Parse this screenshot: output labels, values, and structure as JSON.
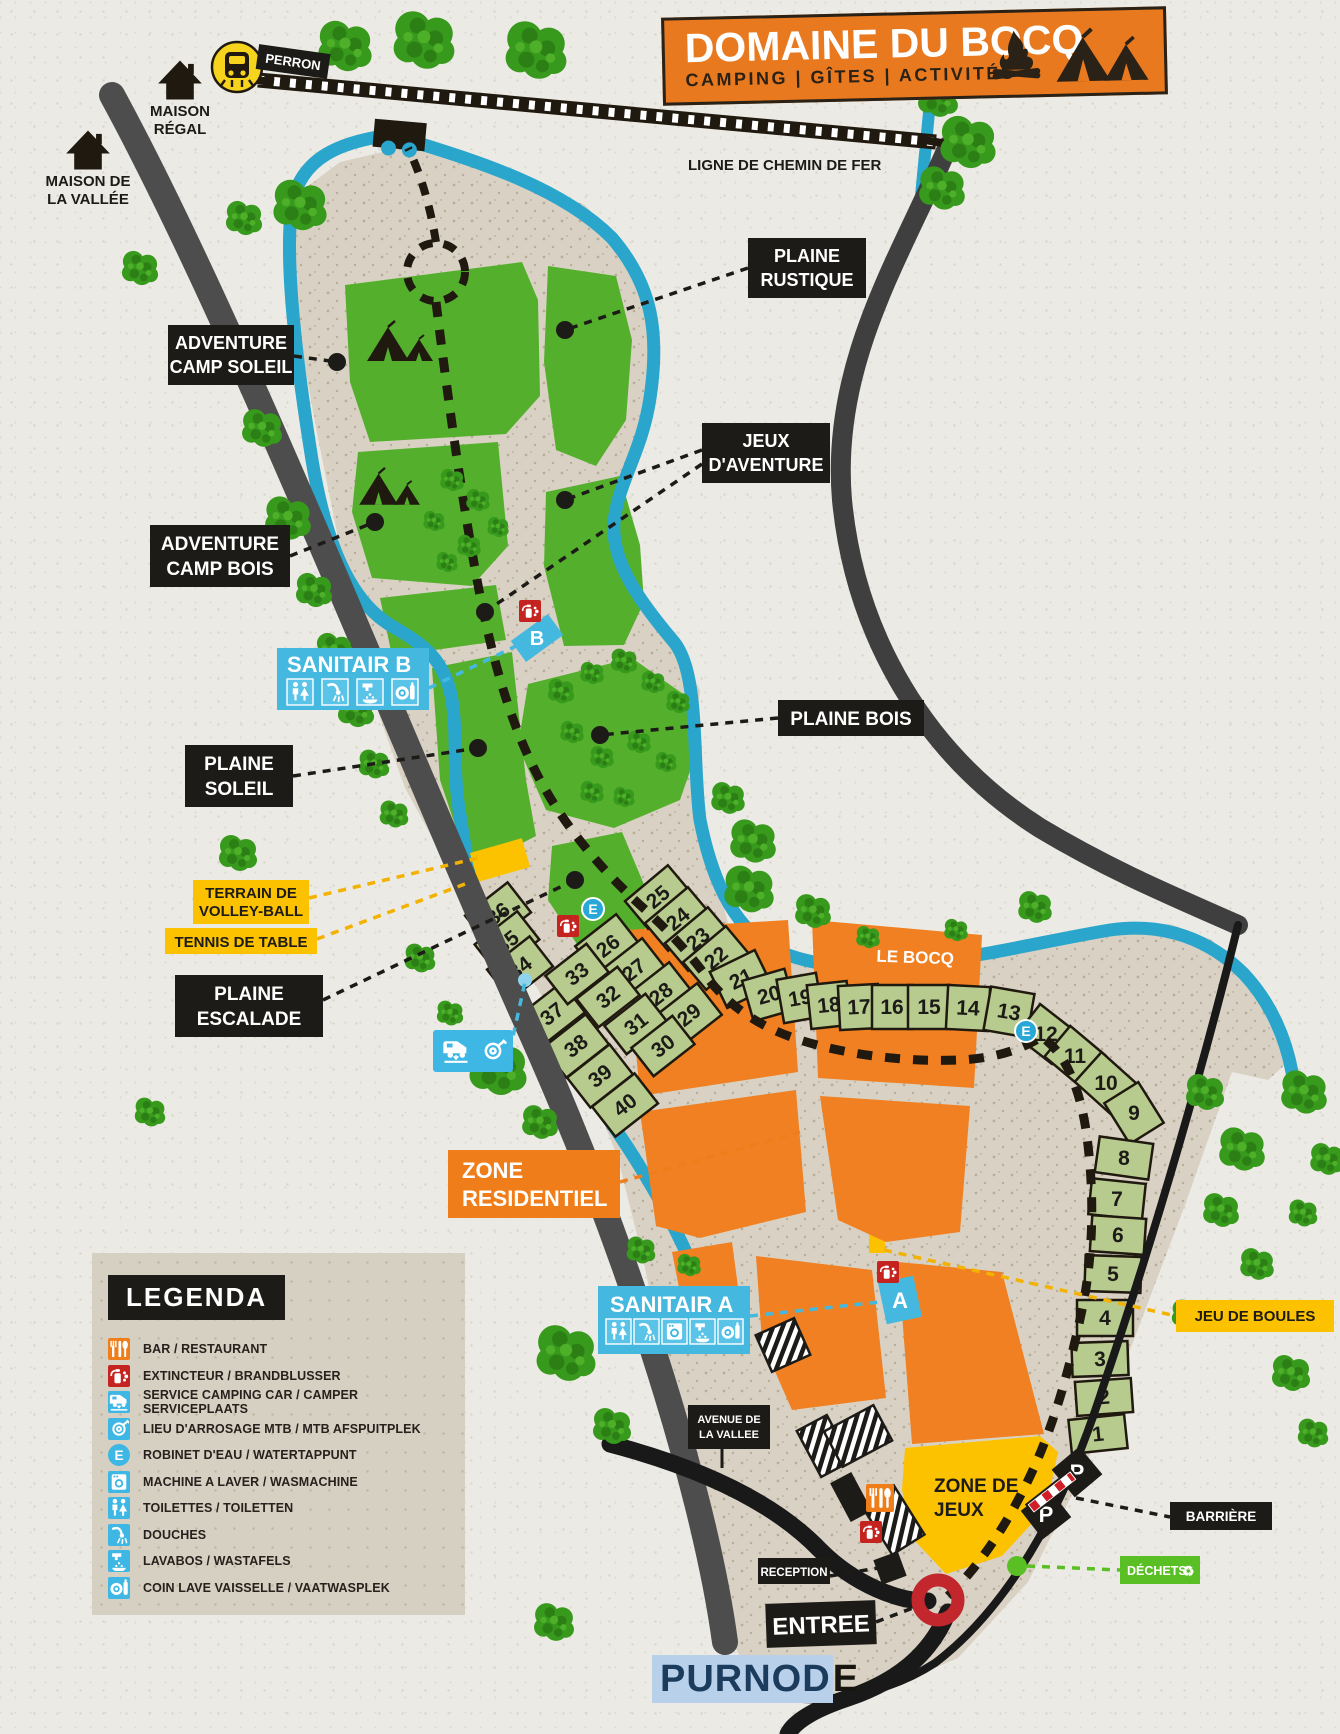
{
  "header": {
    "title": "DOMAINE DU BOCQ",
    "subtitle": "CAMPING | GÎTES | ACTIVITÉS"
  },
  "landmarks": {
    "maison_regal_line1": "MAISON",
    "maison_regal_line2": "RÉGAL",
    "maison_vallee_line1": "MAISON DE",
    "maison_vallee_line2": "LA VALLÉE",
    "perron": "PERRON",
    "railway": "LIGNE DE CHEMIN DE FER",
    "village_part1": "PURNOD",
    "village_part2": "E"
  },
  "river": {
    "name": "LE BOCQ"
  },
  "areas": {
    "adventure_camp_soleil": [
      "ADVENTURE",
      "CAMP SOLEIL"
    ],
    "plaine_rustique": [
      "PLAINE",
      "RUSTIQUE"
    ],
    "jeux_aventure": [
      "JEUX",
      "D'AVENTURE"
    ],
    "adventure_camp_bois": [
      "ADVENTURE",
      "CAMP BOIS"
    ],
    "plaine_soleil": [
      "PLAINE",
      "SOLEIL"
    ],
    "plaine_bois": "PLAINE BOIS",
    "terrain_volley": [
      "TERRAIN DE",
      "VOLLEY-BALL"
    ],
    "tennis_table": "TENNIS DE TABLE",
    "plaine_escalade": [
      "PLAINE",
      "ESCALADE"
    ],
    "zone_residentiel": [
      "ZONE",
      "RESIDENTIEL"
    ],
    "zone_jeux": [
      "ZONE DE",
      "JEUX"
    ],
    "jeu_boules": "JEU DE BOULES"
  },
  "facilities": {
    "sanitair_a": "SANITAIR A",
    "sanitair_b": "SANITAIR B",
    "sanitair_a_letter": "A",
    "sanitair_b_letter": "B",
    "water_letter": "E",
    "parking_letter": "P",
    "avenue_line1": "AVENUE DE",
    "avenue_line2": "LA VALLEE",
    "reception": "RECEPTION",
    "entree": "ENTREE",
    "barriere": "BARRIÈRE",
    "dechets": "DÉCHETS"
  },
  "legend": {
    "title": "LEGENDA",
    "items": [
      {
        "label": "BAR / RESTAURANT",
        "color": "#ef7d1a",
        "icon": "bar-restaurant-icon"
      },
      {
        "label": "EXTINCTEUR / BRANDBLUSSER",
        "color": "#c5231f",
        "icon": "extinguisher-icon"
      },
      {
        "label": "SERVICE CAMPING CAR / CAMPER SERVICEPLAATS",
        "color": "#3eb7e5",
        "icon": "camper-service-icon"
      },
      {
        "label": "LIEU D'ARROSAGE MTB / MTB AFSPUITPLEK",
        "color": "#3eb7e5",
        "icon": "mtb-wash-icon"
      },
      {
        "label": "ROBINET D'EAU / WATERTAPPUNT",
        "color": "#3eb7e5",
        "icon": "water-tap-icon"
      },
      {
        "label": "MACHINE A LAVER / WASMACHINE",
        "color": "#3eb7e5",
        "icon": "washing-machine-icon"
      },
      {
        "label": "TOILETTES / TOILETTEN",
        "color": "#3eb7e5",
        "icon": "toilets-icon"
      },
      {
        "label": "DOUCHES",
        "color": "#3eb7e5",
        "icon": "shower-icon"
      },
      {
        "label": "LAVABOS / WASTAFELS",
        "color": "#3eb7e5",
        "icon": "sink-icon"
      },
      {
        "label": "COIN LAVE VAISSELLE / VAATWASPLEK",
        "color": "#3eb7e5",
        "icon": "dishwashing-icon"
      }
    ]
  },
  "plots": [
    "1",
    "2",
    "3",
    "4",
    "5",
    "6",
    "7",
    "8",
    "9",
    "10",
    "11",
    "12",
    "13",
    "14",
    "15",
    "16",
    "17",
    "18",
    "19",
    "20",
    "21",
    "22",
    "23",
    "24",
    "25",
    "26",
    "27",
    "28",
    "29",
    "30",
    "31",
    "32",
    "33",
    "34",
    "35",
    "36",
    "37",
    "38",
    "39",
    "40"
  ],
  "colors": {
    "banner_orange": "#e8791f",
    "map_green": "#54b02c",
    "plot_green": "#b7cb8e",
    "river_blue": "#2aa5cb",
    "ground_tan": "#d9d2c4",
    "orange_zone": "#f08021",
    "yellow": "#fcc200",
    "label_black": "#1d1b17",
    "label_blue": "#45b8e0",
    "red": "#c5231f",
    "dechets_green": "#5abf25"
  }
}
